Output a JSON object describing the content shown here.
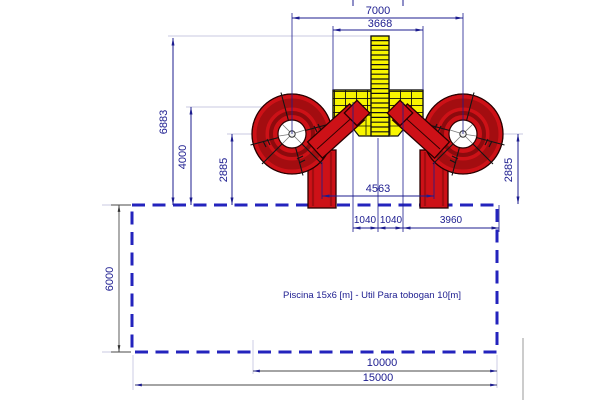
{
  "drawing": {
    "pool_note": "Piscina 15x6 [m] - Util Para tobogan 10[m]",
    "dims": {
      "overall_width": "7000",
      "platform_width": "3668",
      "total_height": "6883",
      "tower_height": "4000",
      "bowl_offset_left": "2885",
      "bowl_offset_right": "2885",
      "exit_spacing": "4563",
      "entry_offset_left": "1040",
      "entry_offset_right": "1040",
      "side_clearance": "3960",
      "pool_width": "6000",
      "slide_usable_length": "10000",
      "pool_length": "15000"
    },
    "colors": {
      "navy": "#1c1c8f",
      "poolblue": "#2323bd",
      "lightline": "#c9c9e2",
      "red": "#cd1117",
      "redmid": "#a30d10",
      "reddark": "#5f0509",
      "yellow": "#f8f500"
    }
  }
}
